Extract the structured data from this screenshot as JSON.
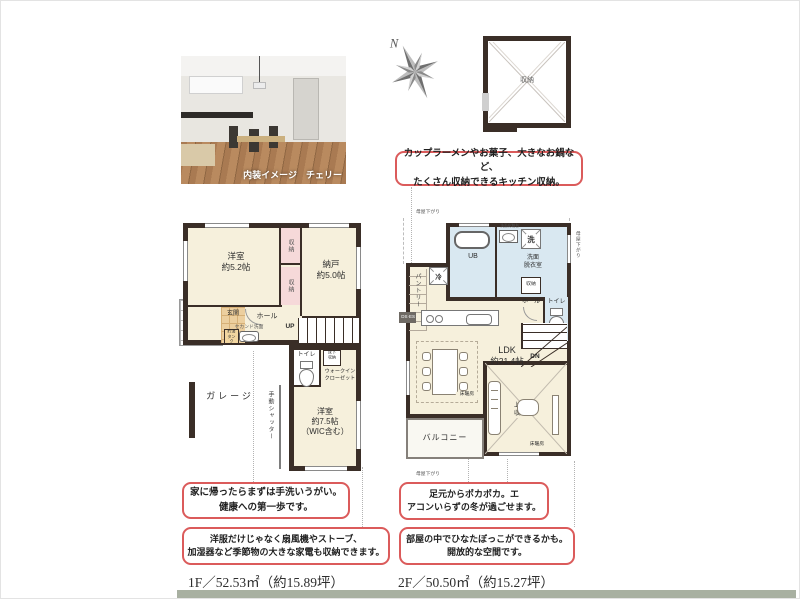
{
  "photo": {
    "caption": "内装イメージ　チェリー"
  },
  "compass": {
    "north": "N"
  },
  "attic": {
    "label": "収納"
  },
  "callouts": {
    "kitchen": [
      "カップラーメンやお菓子、大きなお鍋など、",
      "たくさん収納できるキッチン収納。"
    ],
    "handwash": [
      "家に帰ったらまずは手洗いうがい。",
      "健康への第一歩です。"
    ],
    "seasonal": [
      "洋服だけじゃなく扇風機やストーブ、",
      "加湿器など季節物の大きな家電も収納できます。"
    ],
    "heating": [
      "足元からポカポカ。エ",
      "アコンいらずの冬が過ごせます。"
    ],
    "sunny": [
      "部屋の中でひなたぼっこができるかも。",
      "開放的な空間です。"
    ]
  },
  "floor1": {
    "area": "1F／52.53㎡（約15.89坪）",
    "bedroom52": [
      "洋室",
      "約5.2帖"
    ],
    "nando": [
      "納戸",
      "約5.0帖"
    ],
    "closet": "収納",
    "entrance": "玄関",
    "hall": "ホール",
    "second_basin": "セカンド洗面",
    "tank": [
      "貯湯",
      "タンク"
    ],
    "up": "UP",
    "toilet": "トイレ",
    "underfloor": [
      "床下",
      "収納"
    ],
    "wic": [
      "ウォークイン",
      "クローゼット"
    ],
    "garage": "ガレージ",
    "shutter": "手動シャッター",
    "bedroom75": [
      "洋室",
      "約7.5帖",
      "（WIC含む）"
    ]
  },
  "floor2": {
    "area": "2F／50.50㎡（約15.27坪）",
    "moya": "母屋下がり",
    "ub": "UB",
    "washer": "洗",
    "powder": [
      "洗面",
      "脱衣室"
    ],
    "vanity": "洗面化粧台",
    "fridge": "冷",
    "pantry": "パントリー",
    "closet": "収納",
    "hall": "ホール",
    "toilet": "トイレ",
    "duct": "DS·ES",
    "ldk": [
      "LDK",
      "約21.4帖"
    ],
    "dn": "DN",
    "heating": "床暖房",
    "upper_storage": [
      "上部",
      "収納"
    ],
    "balcony": "バルコニー"
  },
  "colors": {
    "accent_red": "#db5b5b",
    "wall": "#3a2e27",
    "floor_cream": "#f6f0dc",
    "wet_area_blue": "#d9e8f1",
    "closet_pink": "#f6d9d9",
    "entry_tile": "#eccf9f",
    "footer_bar": "#a8b0a1"
  }
}
